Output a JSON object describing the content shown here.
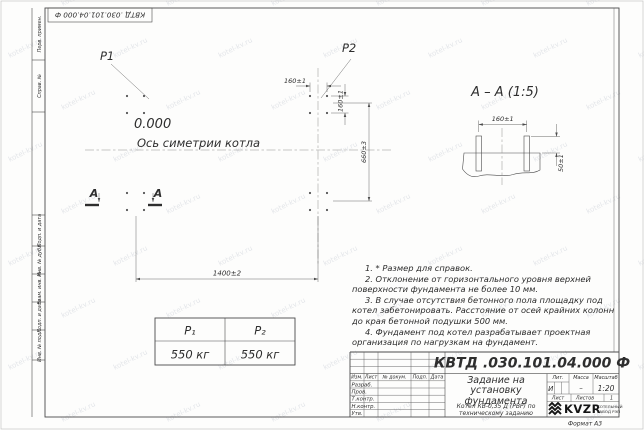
{
  "colors": {
    "line": "#4b4b4b",
    "text": "#2e2e2e",
    "paper": "#fdfdfc",
    "watermark": "#aeb5c4"
  },
  "stamp": {
    "doc_number": "КВТД .030.101.04.000  Ф"
  },
  "left_margin": {
    "fields": [
      "Перв. примен.",
      "Справ. №",
      "Подп. и дата",
      "Инв. № дубл.",
      "Взам. инв. №",
      "Подп. и дата",
      "Инв. № подл."
    ]
  },
  "plan": {
    "p1": "P1",
    "p2": "P2",
    "elevation": "0.000",
    "axis_label": "Ось симетрии котла",
    "dim_bolt_spacing_h": "160±1",
    "dim_bolt_spacing_v": "160±1",
    "dim_depth": "660±3",
    "dim_width": "1400±2",
    "section_letter_1": "А",
    "section_letter_2": "А"
  },
  "section": {
    "title": "А – А (1:5)",
    "dim_bolt_spacing": "160±1",
    "dim_bolt_height": "50±1"
  },
  "load_table": {
    "headers": [
      "P₁",
      "P₂"
    ],
    "values": [
      "550 кг",
      "550 кг"
    ]
  },
  "notes": [
    "1. * Размер для справок.",
    "2. Отклонение от горизонтального уровня верхней поверхности фундамента не более 10 мм.",
    "3. В случае отсутствия бетонного пола площадку под котел забетонировать. Расстояние от осей крайних колонн до края бетонной подушки 500 мм.",
    "4. Фундамент под котел разрабатывает проектная организация по нагрузкам на фундамент."
  ],
  "title_block": {
    "doc_number": "КВТД .030.101.04.000  Ф",
    "title": "Задание на установку фундамента",
    "subtitle": "Котел КВ-0,35 Д (РВР) по техническому заданию",
    "rev_headers": [
      "Изм.",
      "Лист",
      "№ докум.",
      "Подп.",
      "Дата"
    ],
    "sign_rows": [
      "Разраб.",
      "Пров.",
      "Т.контр.",
      "Н.контр.",
      "Утв."
    ],
    "lit_label": "Лит.",
    "mass_label": "Масса",
    "scale_label": "Масштаб",
    "lit_value": "И",
    "mass_value": "–",
    "scale_value": "1:20",
    "sheet_label": "Лист",
    "sheets_label": "Листов",
    "sheets_value": "1",
    "logo_text": "KVZR",
    "company_line1": "КОТЕЛЬНЫЙ",
    "company_line2": "ЗАВОД РЭП"
  },
  "page": {
    "format_label": "Формат А3"
  },
  "watermark": {
    "text": "kotel-kv.ru"
  }
}
